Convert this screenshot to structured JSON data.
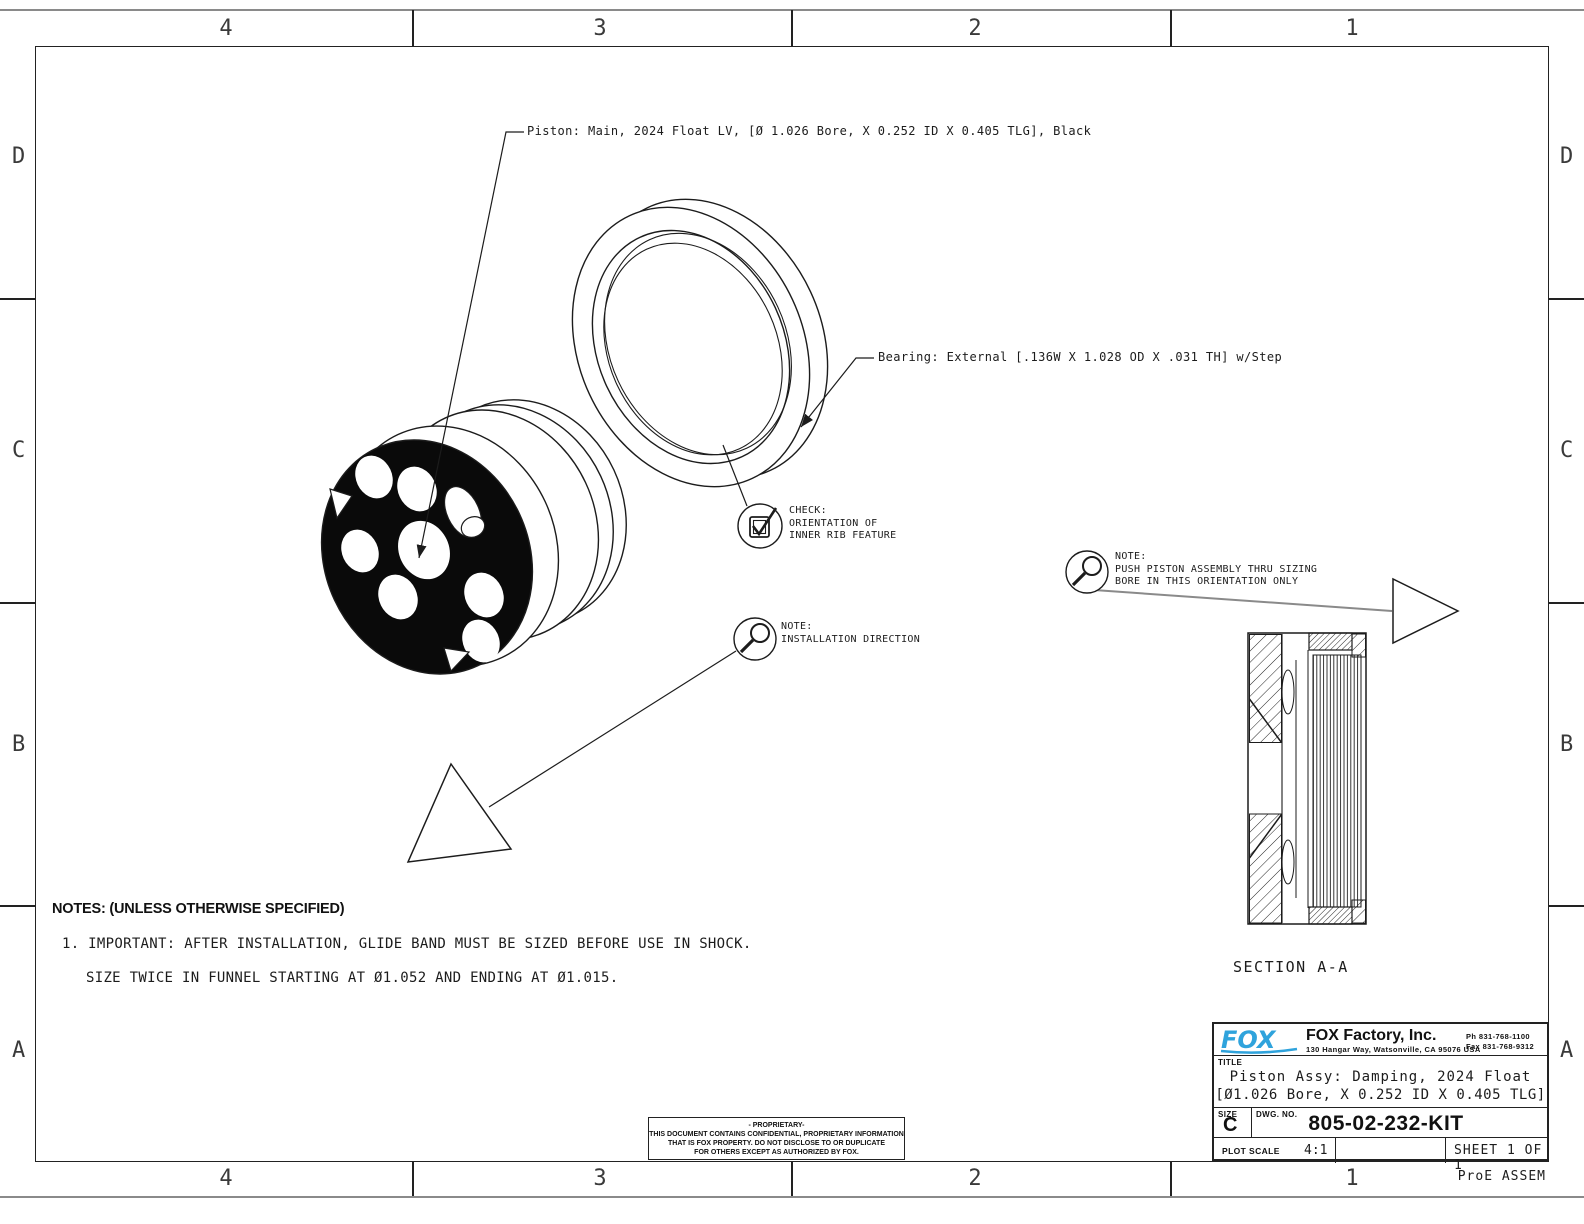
{
  "zones": {
    "top": [
      "4",
      "3",
      "2",
      "1"
    ],
    "bottom": [
      "4",
      "3",
      "2",
      "1"
    ],
    "left": [
      "D",
      "C",
      "B",
      "A"
    ],
    "right": [
      "D",
      "C",
      "B",
      "A"
    ]
  },
  "footer": {
    "pro_e": "ProE ASSEM"
  },
  "callouts": {
    "piston": "Piston: Main, 2024 Float LV, [Ø 1.026 Bore, X 0.252 ID X 0.405 TLG], Black",
    "bearing": "Bearing: External [.136W X 1.028 OD X .031 TH] w/Step",
    "check": "CHECK:\nORIENTATION OF\nINNER RIB FEATURE",
    "note_push": "NOTE:\nPUSH PISTON ASSEMBLY THRU SIZING\nBORE IN THIS ORIENTATION ONLY",
    "note_install": "NOTE:\nINSTALLATION DIRECTION"
  },
  "notes": {
    "header": "NOTES: (UNLESS OTHERWISE SPECIFIED)",
    "line1": "1. IMPORTANT: AFTER INSTALLATION, GLIDE BAND MUST BE SIZED BEFORE USE IN SHOCK.",
    "line2": "SIZE TWICE IN FUNNEL STARTING AT Ø1.052 AND ENDING AT Ø1.015."
  },
  "section": {
    "label": "SECTION A-A"
  },
  "title_block": {
    "logo_text": "FOX",
    "company": "FOX Factory, Inc.",
    "address": "130 Hangar Way, Watsonville, CA 95076 USA",
    "phone": "Ph 831-768-1100",
    "fax": "Fax 831-768-9312",
    "title_label": "TITLE",
    "title_line1": "Piston Assy: Damping, 2024 Float",
    "title_line2": "[Ø1.026 Bore, X 0.252 ID X 0.405 TLG]",
    "size_label": "SIZE",
    "size_value": "C",
    "dwg_label": "DWG. NO.",
    "dwg_number": "805-02-232-KIT",
    "plot_scale_label": "PLOT SCALE",
    "plot_scale_value": "4:1",
    "sheet": "SHEET 1 OF 1"
  },
  "proprietary": {
    "line1": "- PROPRIETARY-",
    "line2": "THIS DOCUMENT CONTAINS CONFIDENTIAL, PROPRIETARY INFORMATION",
    "line3": "THAT IS FOX PROPERTY.  DO NOT DISCLOSE TO OR DUPLICATE",
    "line4": "FOR OTHERS EXCEPT AS AUTHORIZED BY FOX."
  },
  "colors": {
    "line": "#1c1c1c",
    "frame_gray": "#8a8a8a",
    "logo_blue": "#2fa3dc"
  }
}
